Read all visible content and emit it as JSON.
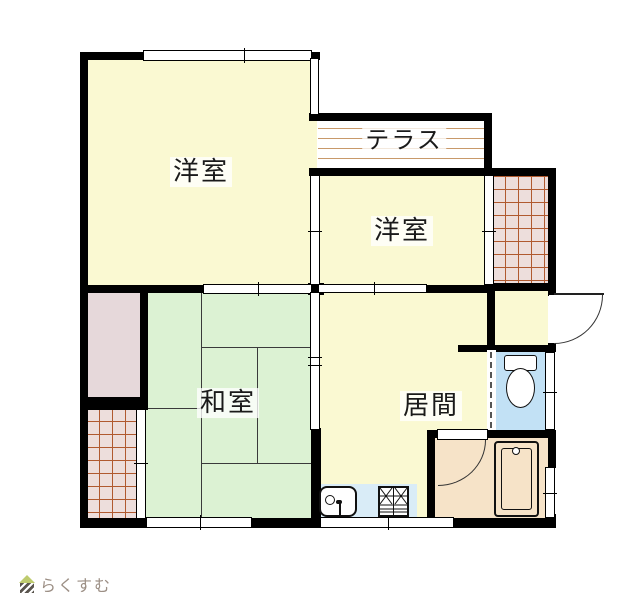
{
  "plan": {
    "type": "floor-plan",
    "rooms": {
      "western1": {
        "label": "洋室"
      },
      "terrace": {
        "label": "テラス"
      },
      "western2": {
        "label": "洋室"
      },
      "japanese": {
        "label": "和室"
      },
      "living": {
        "label": "居間"
      }
    },
    "fixtures": [
      "toilet",
      "bathtub",
      "kitchen-sink",
      "gas-stove",
      "entrance-door",
      "bath-door"
    ]
  },
  "watermark": {
    "text": "らくすむ"
  },
  "colors": {
    "room_yellow": "#faf9d2",
    "tatami_green": "#dcf2d3",
    "closet_pink": "#e6d8da",
    "tile_fill": "#eddedc",
    "tile_line": "#b05a30",
    "terrace_line": "#c8996a",
    "toilet_blue": "#c2e1f5",
    "kitchen_blue": "#d9ecf7",
    "bath_peach": "#f6e3c8",
    "wall": "#000000",
    "logo_text": "#9c8f85",
    "logo_roof": "#becb6e"
  }
}
